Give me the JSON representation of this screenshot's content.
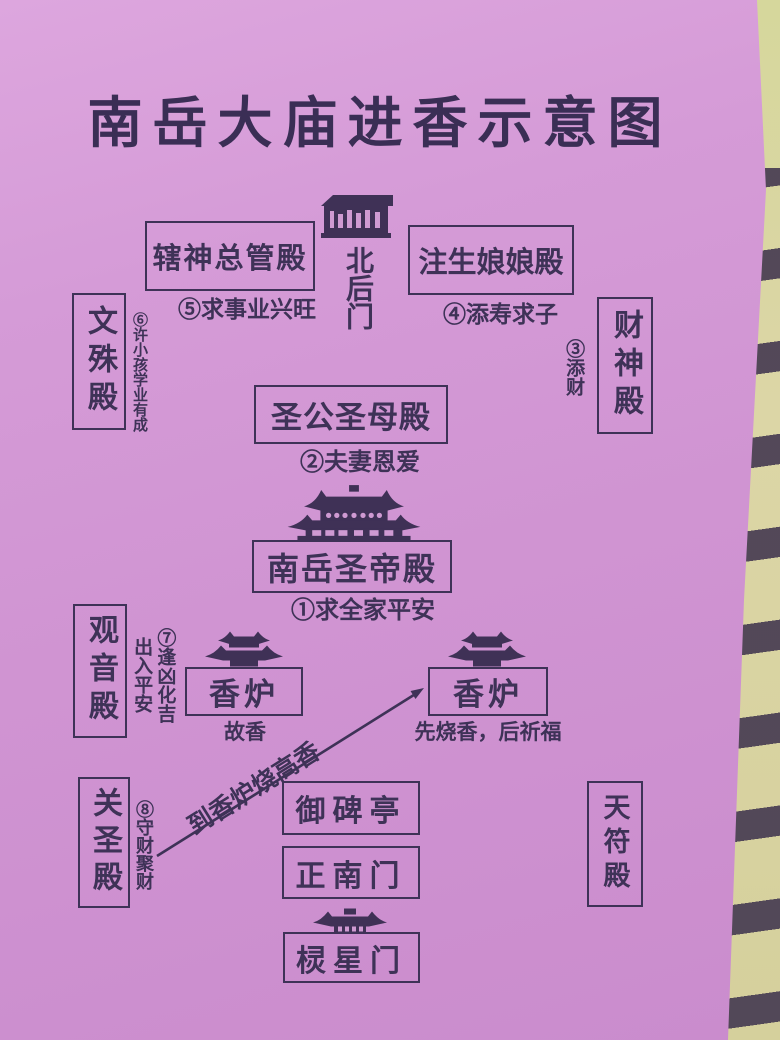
{
  "page": {
    "title": "南岳大庙进香示意图"
  },
  "colors": {
    "paper": "#d094d2",
    "ink": "#3e3257",
    "backdrop": "#d8d4a2",
    "stripe": "#473c52"
  },
  "halls": {
    "xiashen": {
      "label": "辖神总管殿",
      "note": "⑤求事业兴旺"
    },
    "north_gate": {
      "label": "北后门"
    },
    "zhusheng": {
      "label": "注生娘娘殿",
      "note": "④添寿求子"
    },
    "wenshu": {
      "label": "文殊殿",
      "note": "⑥许小孩学业有成"
    },
    "caishen": {
      "label": "财神殿",
      "note": "③添财"
    },
    "shenggong": {
      "label": "圣公圣母殿",
      "note": "②夫妻恩爱"
    },
    "shengdi": {
      "label": "南岳圣帝殿",
      "note": "①求全家平安"
    },
    "guanyin": {
      "label": "观音殿",
      "note": "⑦逢凶化吉\n出入平安"
    },
    "incense_left": {
      "label": "香炉",
      "note": "故香"
    },
    "incense_right": {
      "label": "香炉",
      "note": "先烧香，后祈福"
    },
    "guansheng": {
      "label": "关圣殿",
      "note": "⑧守财聚财"
    },
    "yubeiting": {
      "label": "御碑亭"
    },
    "zhengnanmen": {
      "label": "正南门"
    },
    "lingxingmen": {
      "label": "棂星门"
    },
    "tianfu": {
      "label": "天符殿"
    }
  },
  "arrow": {
    "label": "到香炉烧高香"
  },
  "icons": {
    "north_gate": "north-gate-building-icon",
    "main_hall": "grand-hall-roof-icon",
    "incense_left": "pavilion-roof-icon",
    "incense_right": "pavilion-roof-icon",
    "south_gate": "lingxing-gate-roof-icon"
  }
}
